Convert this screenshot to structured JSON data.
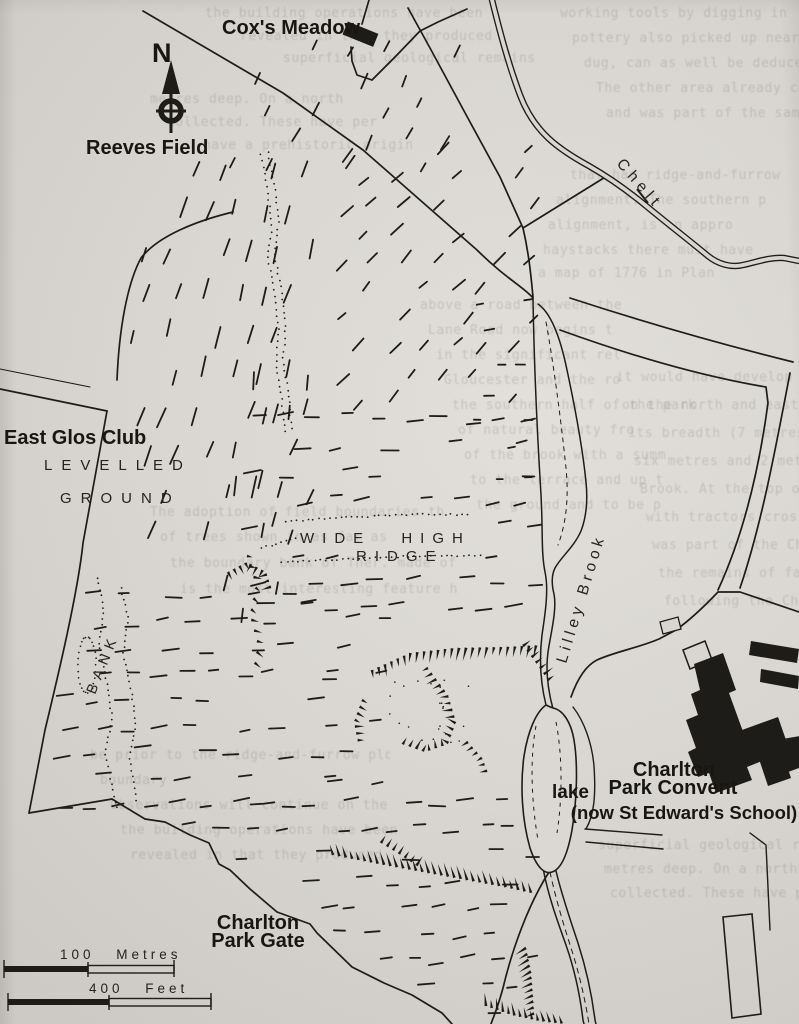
{
  "map": {
    "colors": {
      "ink": "#1d1c18",
      "paper": "#d9d6d1",
      "ghost_text": "#46403a"
    },
    "labels": {
      "north_indicator": "N",
      "coxs_meadow": "Cox's Meadow",
      "reeves_field": "Reeves Field",
      "east_glos_club": "East Glos Club",
      "levelled": "LEVELLED",
      "ground": "GROUND",
      "wide_high": "WIDE HIGH",
      "ridge": "RIDGE",
      "bank": "BANK",
      "chelt": "Chelt",
      "lilley_brook": "Lilley Brook",
      "lake": "lake",
      "convent_line1": "Charlton",
      "convent_line2": "Park Convent",
      "convent_line3": "(now St Edward's School)",
      "gate_line1": "Charlton",
      "gate_line2": "Park Gate",
      "scale_metres": "100 Metres",
      "scale_feet": "400 Feet"
    },
    "bleedthrough_fragments": [
      "the building operations have been",
      "revealed in that they produced",
      "superficial geological remains",
      "metres deep. On a north",
      "collected. These have per",
      "have a prehistoric origin",
      "working tools by digging in",
      "pottery also picked up near",
      "dug, can as well be deduced",
      "The other area already cover",
      "and was part of the same f",
      "that had ridge-and-furrow",
      "alignment. The southern p",
      "alignment, is an appro",
      "haystacks there must have",
      "a map of 1776 in Plan",
      "above a road between the",
      "Lane Road now begins t",
      "in the significant rel",
      "Gloucester and the ro",
      "the southern half of the park",
      "of natural beauty fro",
      "of the brook with a summ",
      "to the terrace and up t",
      "the ground and to be p",
      "it would have develop",
      "on the north and east side the field",
      "its breadth (7 metres) alongside fos",
      "six metres and 2 metres from the ba",
      "Brook. At the top of this slope",
      "with tractors crossed the Park in",
      "was part of the Chelt and go no",
      "the remains of family fields here",
      "following the Charlton parts b",
      "The adoption of field boundaries th",
      "of trees shown in as far as",
      "the boundary bank of Ther. made of",
      "is the most interesting feature h",
      "be prior to the ridge-and-furrow plo",
      "boundary",
      "Observations will continue on the"
    ]
  }
}
